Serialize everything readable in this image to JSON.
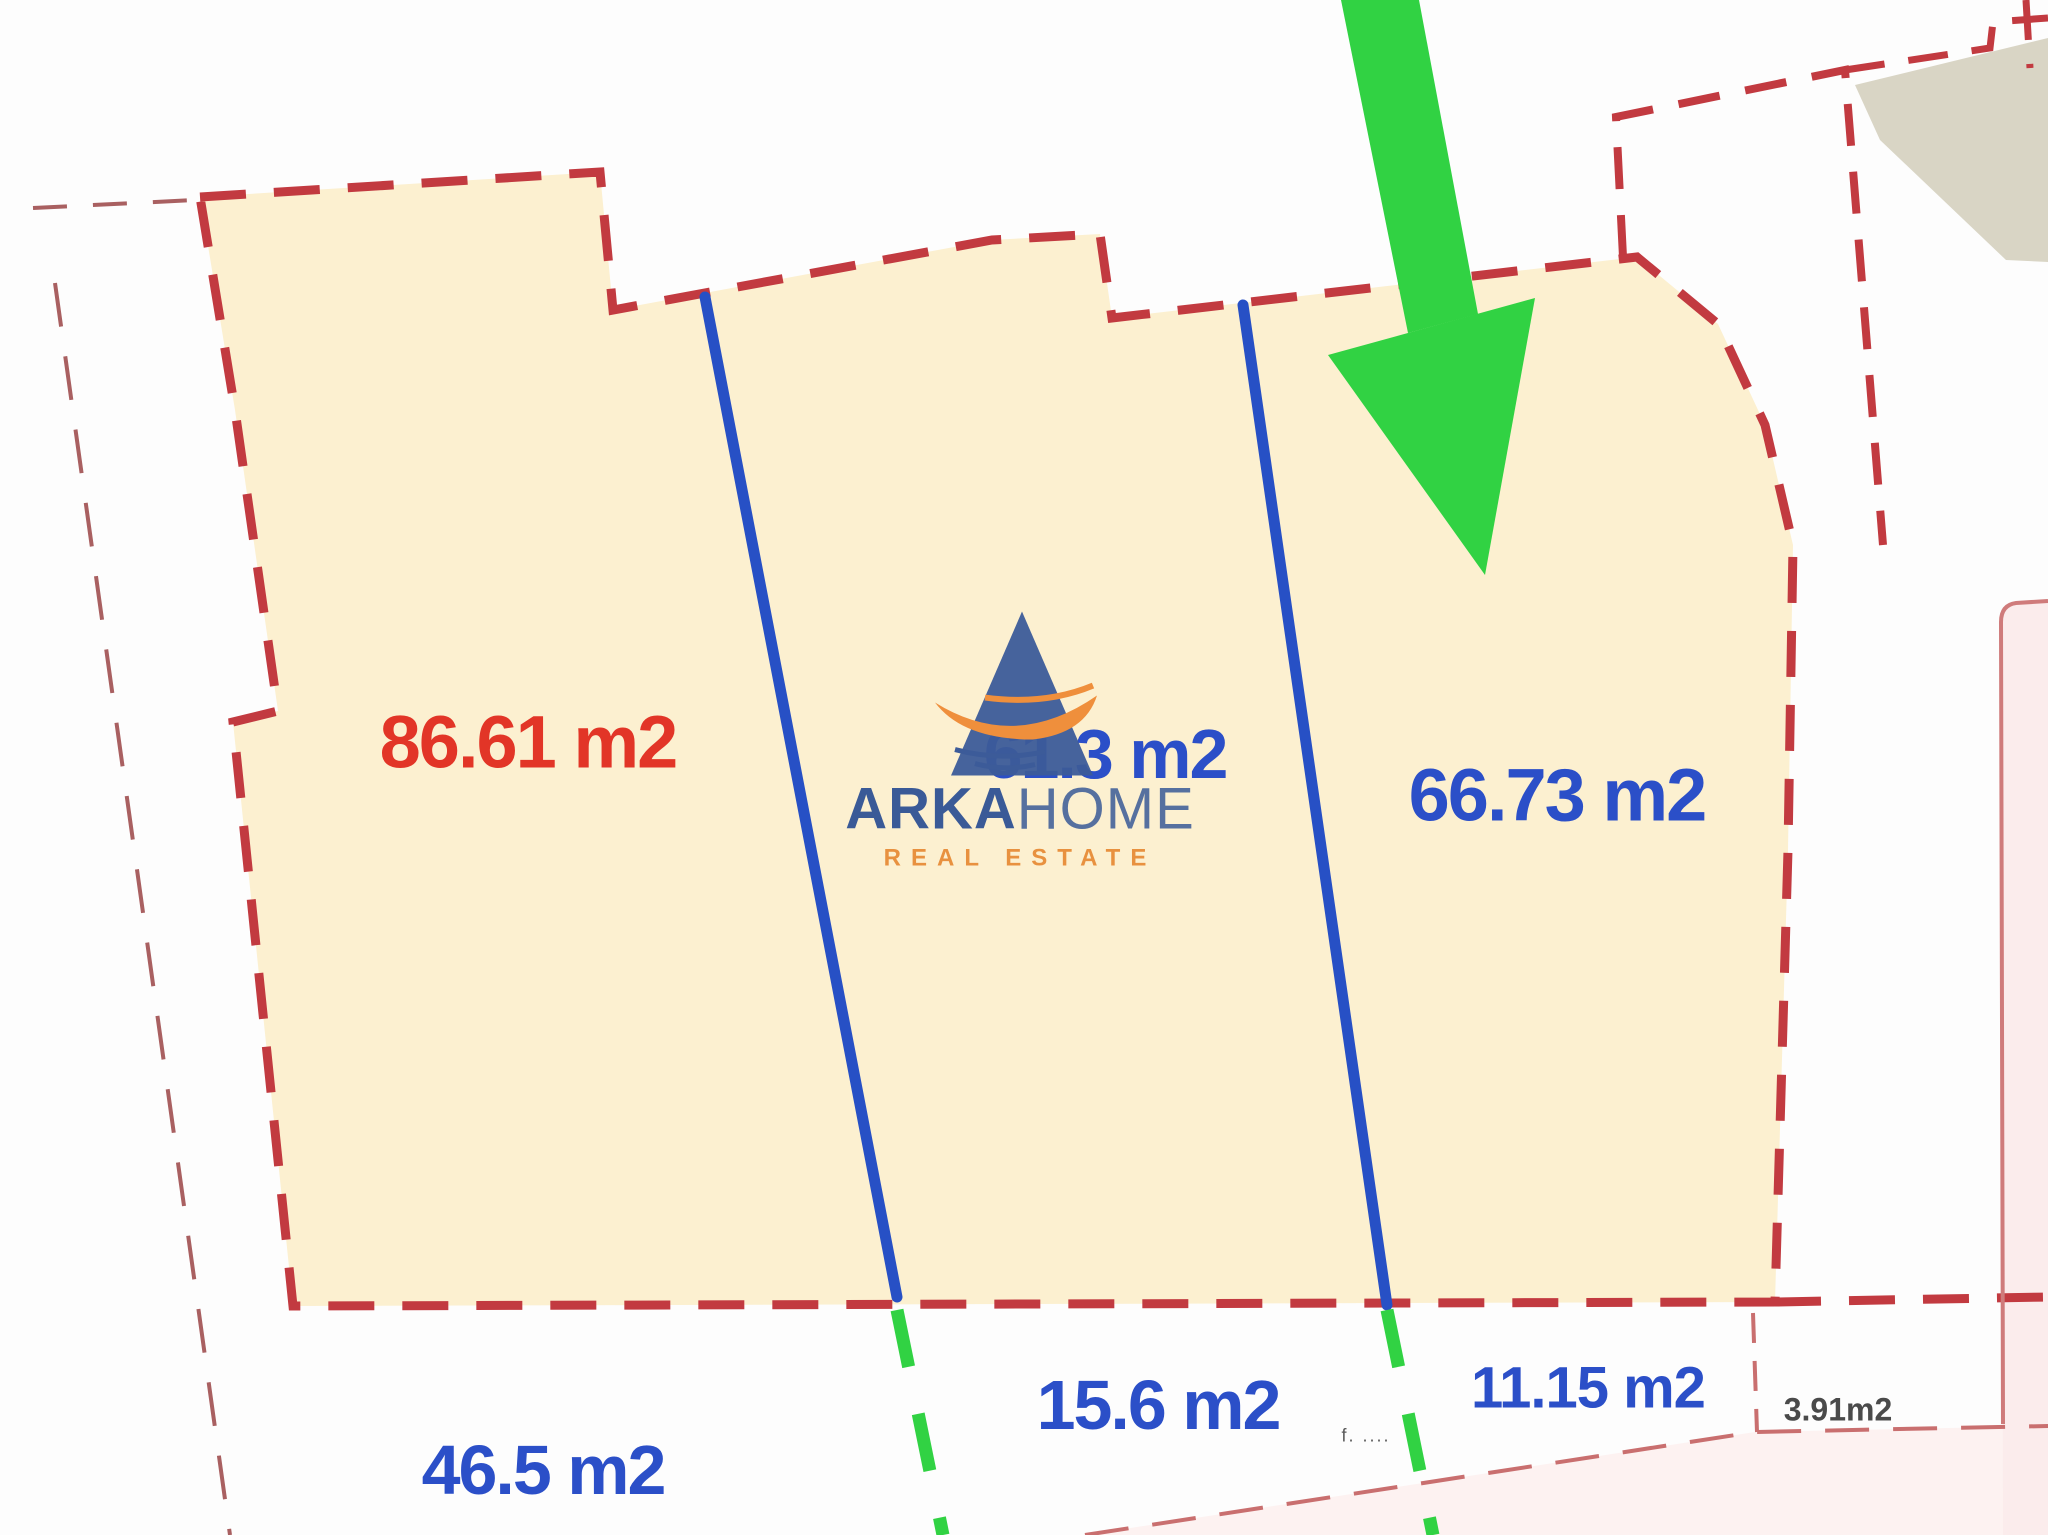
{
  "document": {
    "type": "cadastral-parcel-plan",
    "background": "#fdfdfd"
  },
  "watermark": {
    "brand_bold": "ARKA",
    "brand_light": "HOME",
    "tagline": "REAL ESTATE",
    "brand_color": "#3a5a97",
    "tagline_color": "#e8913f"
  },
  "parcel_labels": {
    "section_left": "86.61 m2",
    "section_middle": "61.3 m2",
    "section_right": "66.73 m2",
    "strip_left": "46.5 m2",
    "strip_middle": "15.6 m2",
    "strip_right": "11.15 m2",
    "strip_far_right": "3.91m2",
    "tiny_note": "f. ...."
  },
  "legend_colors": {
    "parcel_fill": "#fcf0d0",
    "parcel_border_red": "#c23a40",
    "divider_blue": "#2750c5",
    "continuation_green": "#31d243",
    "arrow_green": "#31d243",
    "outer_boundary_thin": "#a96061",
    "pink_boundary": "#cf7b7b",
    "label_red": "#e23527",
    "label_blue": "#2b4fc8",
    "neighbor_fill_gray": "#d9d5c5",
    "pink_fill": "#fbecec"
  }
}
